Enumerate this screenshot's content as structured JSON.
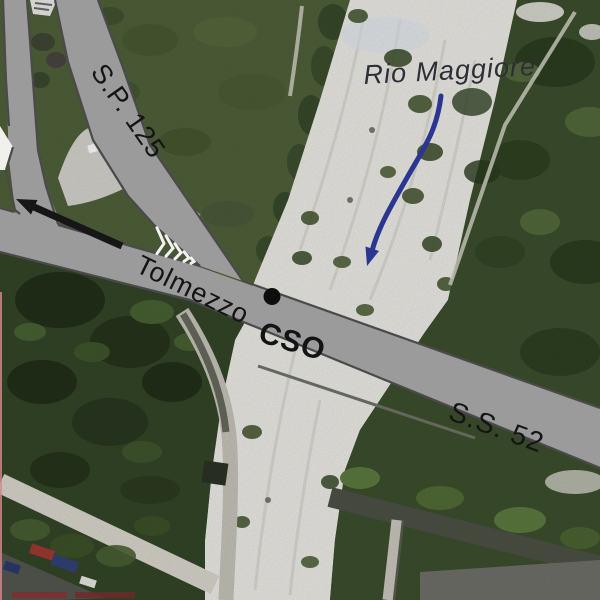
{
  "labels": {
    "sp125": "S.P. 125",
    "tolmezzo": "Tolmezzo",
    "cso": "CSO",
    "ss52": "S.S. 52",
    "river": "Rio Maggiore"
  },
  "marker": {
    "name": "cso-site-dot",
    "shape": "filled-circle"
  },
  "arrows": {
    "road_arrow": "direction-to-Tolmezzo",
    "river_arrow": "river-flow-direction"
  },
  "colors": {
    "road_fill": "#9b9b9b",
    "road_outline": "#4a4a4a",
    "river_gravel": "#efeee9",
    "field_green": "#50613a",
    "forest_green": "#3d4f2d",
    "dark_forest": "#344628",
    "arrow_blue": "#2b3693",
    "label_text": "#141414"
  }
}
